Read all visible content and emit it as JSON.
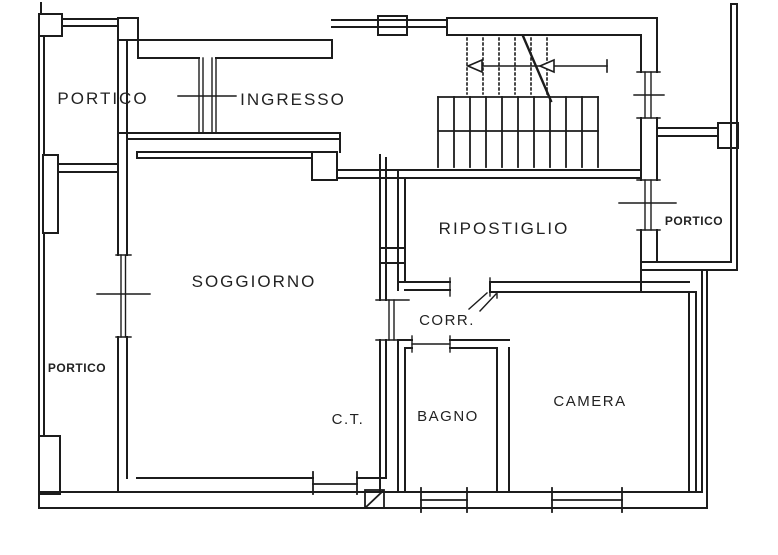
{
  "document": {
    "type": "floor-plan",
    "style": "architectural line drawing"
  },
  "colors": {
    "background": "#ffffff",
    "wall_line": "#1c1c1c",
    "label_text": "#222222"
  },
  "rooms": {
    "portico_top": {
      "label": "PORTICO"
    },
    "ingresso": {
      "label": "INGRESSO"
    },
    "ripostiglio": {
      "label": "RIPOSTIGLIO"
    },
    "portico_right": {
      "label": "PORTICO"
    },
    "portico_left": {
      "label": "PORTICO"
    },
    "soggiorno": {
      "label": "SOGGIORNO"
    },
    "ct": {
      "label": "C.T."
    },
    "corr": {
      "label": "CORR."
    },
    "bagno": {
      "label": "BAGNO"
    },
    "camera": {
      "label": "CAMERA"
    }
  },
  "symbols": {
    "stairs": "staircase with up-direction arrows and break line",
    "doors": [
      "portico-ingresso door",
      "ripostiglio-portico door",
      "ripostiglio-corridor door",
      "corridor-bagno door",
      "camera door",
      "soggiorno-corridor door"
    ],
    "windows": [
      "left wall window",
      "stair wall window",
      "soggiorno window",
      "bagno window",
      "camera window"
    ],
    "hatch": "duct / chimney hatched square"
  }
}
